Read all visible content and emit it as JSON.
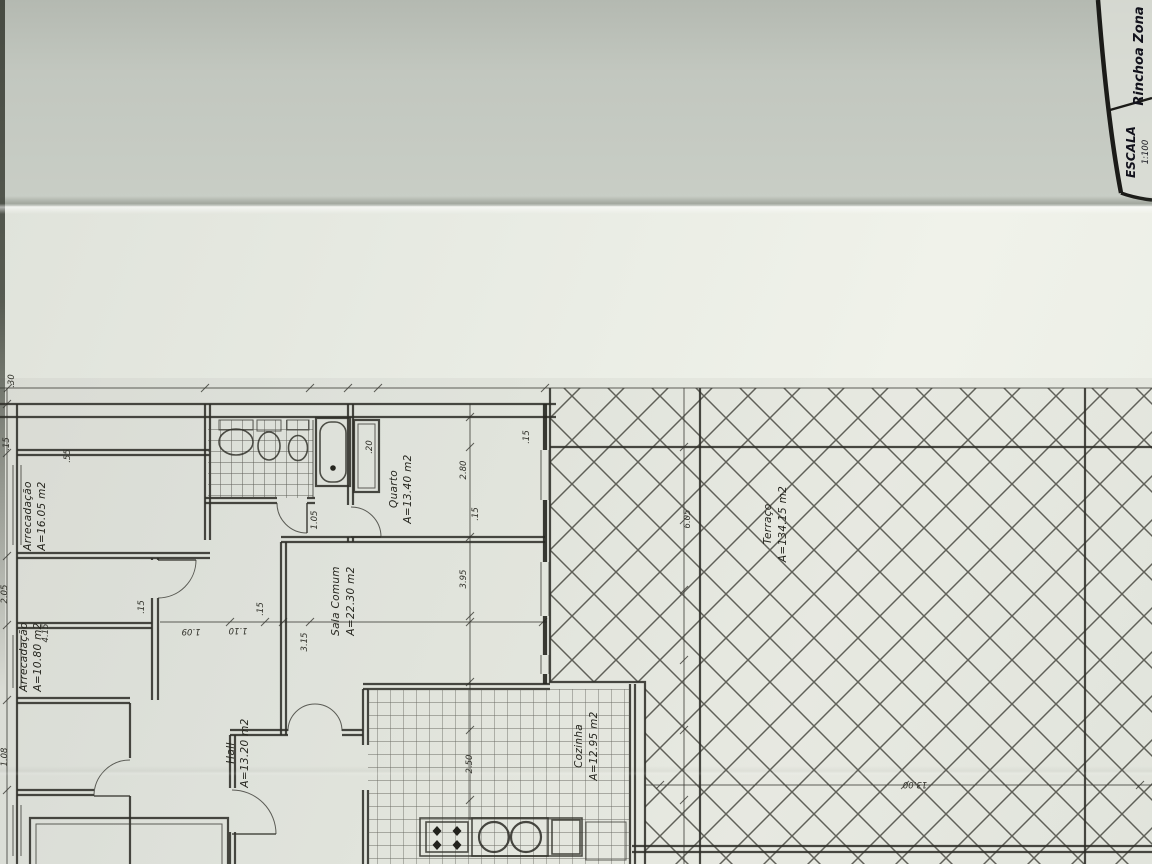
{
  "title_block": {
    "location": "Rinchoa Zona",
    "scale_label": "ESCALA",
    "scale_value": "1:100"
  },
  "rooms": [
    {
      "name": "Arrecadação",
      "area": "A=16.05 m2"
    },
    {
      "name": "Arrecadação",
      "area": "A=10.80 m2"
    },
    {
      "name": "Hall",
      "area": "A=13.20 m2"
    },
    {
      "name": "Sala Comum",
      "area": "A=22.30 m2"
    },
    {
      "name": "Quarto",
      "area": "A=13.40 m2"
    },
    {
      "name": "Cozinha",
      "area": "A=12.95 m2"
    },
    {
      "name": "Terraço",
      "area": "A=134.15 m2"
    }
  ],
  "dimensions": [
    ".30",
    ".15",
    "2.05",
    "1.08",
    ".55",
    "4.15",
    ".15",
    "1.09",
    "1.10",
    ".15",
    "3.15",
    "2.80",
    ".15",
    "3.95",
    "2.50",
    "6.05",
    "13.00",
    ".15",
    "1.05",
    ".20"
  ],
  "fixtures": [
    "washbasin",
    "toilet",
    "bidet",
    "bathtub",
    "shaft",
    "stove",
    "double-sink",
    "kitchen-counter"
  ],
  "colors": {
    "ink": "#2e2e28",
    "paper_upper": "#c2c7bf",
    "paper_lower": "#eaede5"
  }
}
